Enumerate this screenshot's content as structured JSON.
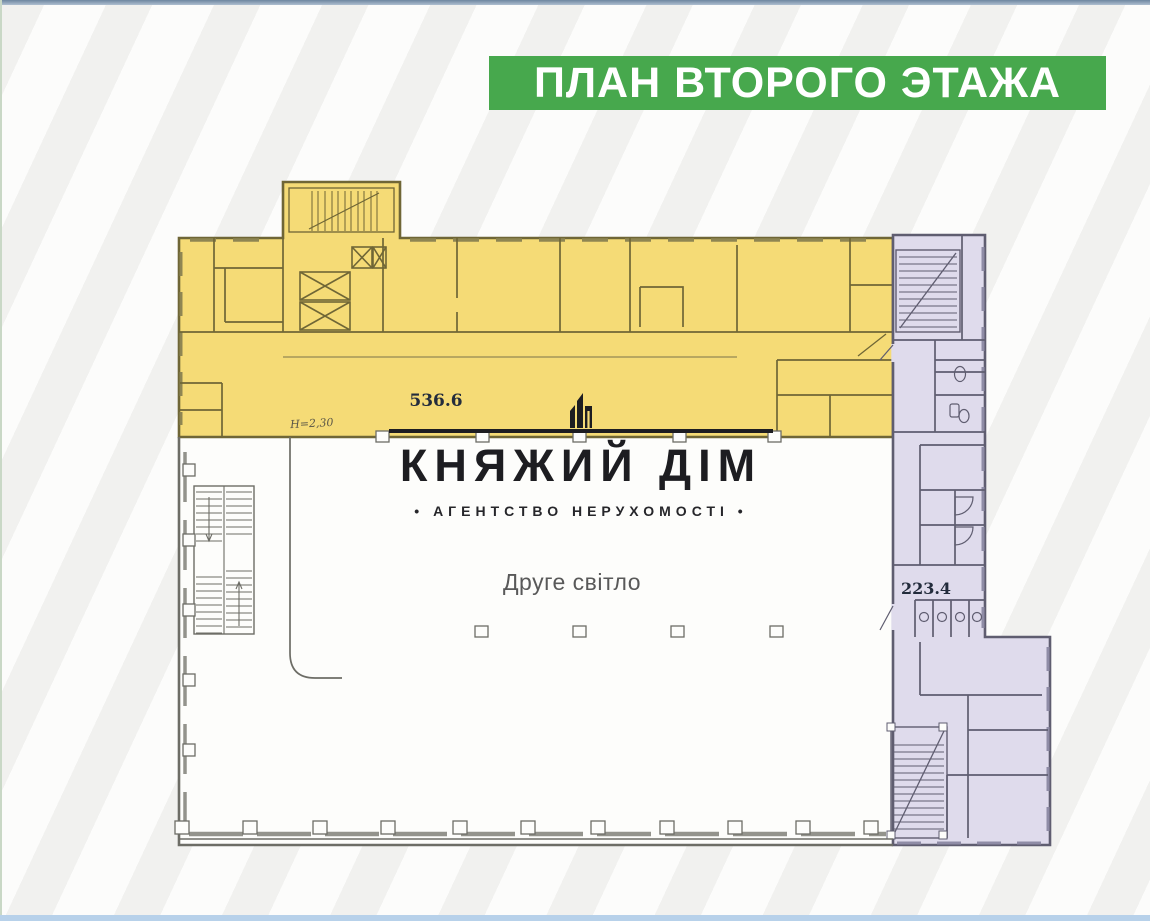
{
  "banner": {
    "title": "ПЛАН ВТОРОГО ЭТАЖА"
  },
  "logo": {
    "name": "КНЯЖИЙ ДІМ",
    "tagline": "• АГЕНТСТВО НЕРУХОМОСТІ •",
    "icon": "building-skyline-icon"
  },
  "floor_plan": {
    "yellow_zone": {
      "area": "536.6",
      "note": "Н=2,30",
      "fill": "#f5db76"
    },
    "purple_zone": {
      "area": "223.4",
      "fill": "#dfdbec"
    },
    "atrium": {
      "label": "Друге світло",
      "fill": "#fdfdfb"
    }
  },
  "colors": {
    "banner_green": "#47a84d",
    "banner_text": "#ffffff",
    "top_bar": "#7e95ac",
    "bottom_bar": "#b7d1ea",
    "yellow_walls": "#6f6636",
    "purple_walls": "#5f5d70",
    "plan_walls": "#6d6d66"
  }
}
